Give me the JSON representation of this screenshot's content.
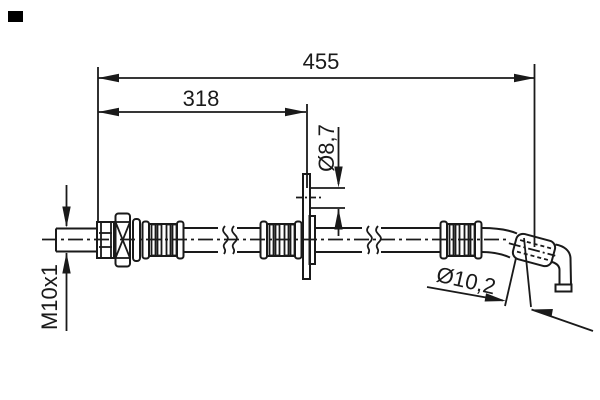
{
  "drawing": {
    "description": "Technical line drawing of a brake hose with dimension callouts",
    "background_color": "#ffffff",
    "line_color": "#1a1a1a",
    "dimensions": {
      "overall_length": "455",
      "intermediate_length": "318",
      "bracket_hole_diameter": "Ø8,7",
      "end_fitting_diameter": "Ø10,2",
      "thread_size": "M10x1"
    }
  }
}
